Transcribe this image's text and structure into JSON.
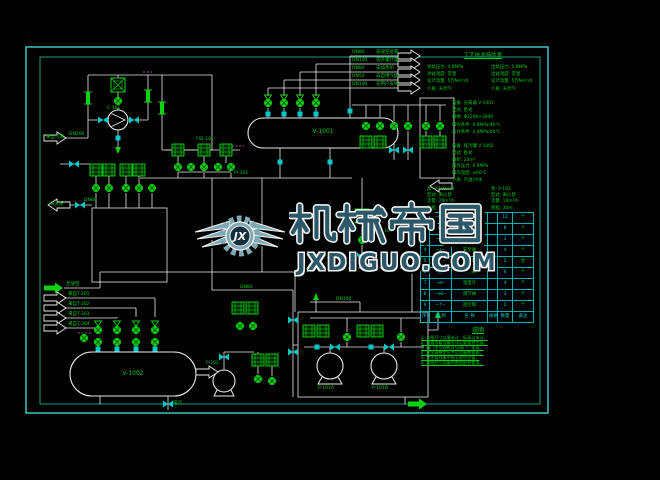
{
  "watermark": {
    "brand": "机械帝国",
    "site": "JXDIGUO.COM",
    "monogram": "JX"
  },
  "equipment": {
    "vessel_top_tag": "V-1001",
    "vessel_bottom_tag": "V-1002",
    "compressor_tag": "C-101",
    "pump_a_tag": "P-101A",
    "pump_b_tag": "P-101B",
    "pump_small_tag": "P-102",
    "control_valve_tag": "PCV-101",
    "indicator_tag": "PI-101",
    "recorder_tag": "FIQ-101"
  },
  "flows": {
    "inlet_main": "来自气源",
    "inlet_main_pipe": "DN200",
    "flare_out": "去火炬",
    "flare_pipe": "DN80",
    "vent_header": "至放空",
    "drain": "排污",
    "line_mid": "DN80",
    "line_box": "DN100",
    "out1_pipe": "DN80",
    "out1_dest": "去放空总管",
    "out2_pipe": "DN100",
    "out2_dest": "去外输计量",
    "out3_pipe": "DN80",
    "out3_dest": "去加热炉",
    "out4_pipe": "DN50",
    "out4_dest": "去自用气撬",
    "out5_pipe": "DN100",
    "out5_dest": "去用户支线",
    "in1": "来自T-201",
    "in2": "来自T-202",
    "in3": "来自T-203",
    "in4": "来自T-204"
  },
  "spec": {
    "heading": "工艺技术特性表",
    "groups": [
      {
        "lines": [
          "进站压力: 4.0MPa",
          "进站温度: 常温",
          "设计流量: 5万Nm³/d",
          "介质: 天然气"
        ]
      },
      {
        "lines": [
          "出站压力: 1.6MPa",
          "出站温度: 常温",
          "设计流量: 5万Nm³/d",
          "介质: 天然气"
        ]
      },
      {
        "lines": [
          "设备: 分离器 V-1001",
          "型式: 卧式",
          "规格: Φ1200×3000",
          "操作条件: 4.0MPa/40℃",
          "设计条件: 4.4MPa/60℃"
        ]
      },
      {
        "lines": [
          "设备: 排污罐 V-1002",
          "型式: 卧式",
          "容积: 20m³",
          "操作压力: 0.6MPa",
          "操作温度: ≤60℃",
          "介质: 污油/污水"
        ]
      },
      {
        "lines": [
          "泵: P-101A/B",
          "型式: 离心泵",
          "流量: 20m³/h",
          "扬程: 50m"
        ]
      },
      {
        "lines": [
          "泵: P-102",
          "型式: 离心泵",
          "流量: 10m³/h",
          "扬程: 30m"
        ]
      }
    ]
  },
  "legend": {
    "header": [
      "序号",
      "图 例",
      "名 称",
      "规格",
      "数量",
      "备注"
    ],
    "rows": [
      {
        "no": "1",
        "sym": "─⋈─",
        "name": "球阀",
        "spec": "",
        "qty": "12",
        "rem": "个"
      },
      {
        "no": "2",
        "sym": "─⋈─",
        "name": "截止阀",
        "spec": "",
        "qty": "8",
        "rem": "个"
      },
      {
        "no": "3",
        "sym": "─◁│",
        "name": "止回阀",
        "spec": "",
        "qty": "3",
        "rem": "个"
      },
      {
        "no": "4",
        "sym": "─⟂─",
        "name": "安全阀",
        "spec": "",
        "qty": "4",
        "rem": "个"
      },
      {
        "no": "5",
        "sym": "─▭─",
        "name": "过滤器",
        "spec": "",
        "qty": "2",
        "rem": "台"
      },
      {
        "no": "6",
        "sym": "─◯─",
        "name": "压力表",
        "spec": "",
        "qty": "6",
        "rem": "个"
      },
      {
        "no": "7",
        "sym": "─⊖─",
        "name": "温度计",
        "spec": "",
        "qty": "4",
        "rem": "个"
      },
      {
        "no": "8",
        "sym": "─⋈̂─",
        "name": "调节阀",
        "spec": "",
        "qty": "3",
        "rem": "个"
      },
      {
        "no": "9",
        "sym": "─↑─",
        "name": "放空帽",
        "spec": "",
        "qty": "2",
        "rem": "个"
      }
    ]
  },
  "notes": {
    "title": "说明",
    "lines": [
      "1. 本图尺寸以毫米计，标高以米计。",
      "2. 管道等级及编号详见管道特性表。",
      "3. 阀门型号规格详见阀门一览表。",
      "4. 安全阀整定压力见设备数据表。",
      "5. 放空管线集中接至放空总管。",
      "6. 本图应与设备布置图配合使用。"
    ]
  },
  "colors": {
    "accent_green": "#00cf17",
    "accent_cyan": "#00c9c9",
    "line_white": "#e8e8e8",
    "border_cyan": "#45cfcf",
    "watermark_fill": "#2b5868",
    "watermark_wing": "#7fa9b6"
  }
}
